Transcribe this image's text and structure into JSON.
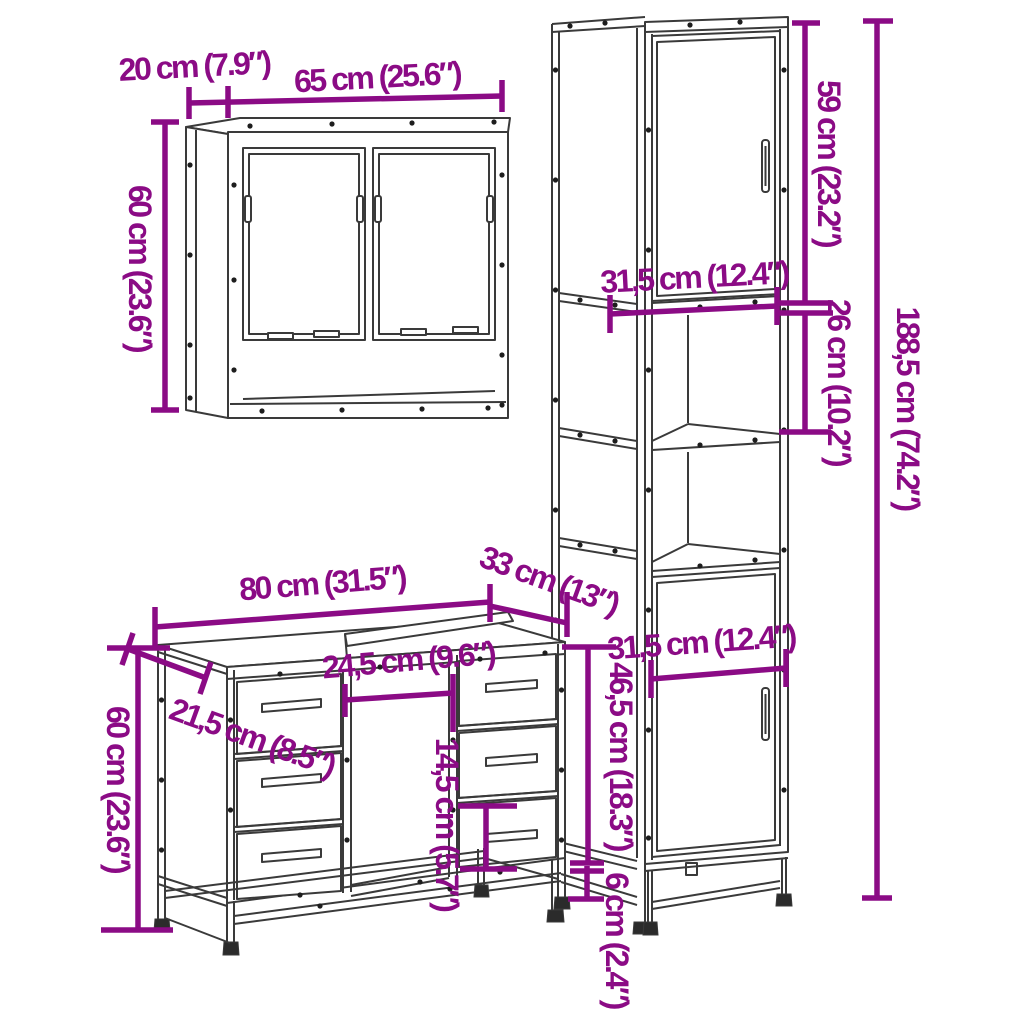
{
  "theme": {
    "accent": "#8b0b85",
    "line": "#3a3a3a",
    "dot": "#1d1d1d",
    "background": "#ffffff"
  },
  "dimensions": {
    "mirror_depth": "20 cm (7.9″)",
    "mirror_width": "65 cm (25.6″)",
    "mirror_height": "60 cm (23.6″)",
    "tall_top_door_height": "59 cm (23.2″)",
    "tall_shelf_width": "31,5 cm (12.4″)",
    "tall_compartment_height": "26 cm (10.2″)",
    "tall_total_height": "188,5 cm (74.2″)",
    "tall_bottom_door_width": "31,5 cm (12.4″)",
    "tall_bottom_door_height": "46,5 cm (18.3″)",
    "tall_leg_height": "6 cm (2.4″)",
    "vanity_width": "80 cm (31.5″)",
    "vanity_depth": "33 cm (13″)",
    "vanity_opening_width": "24,5 cm (9.6″)",
    "vanity_top_depth": "21,5 cm (8.5″)",
    "vanity_height": "60 cm (23.6″)",
    "vanity_drawer_height": "14,5 cm (5.7″)"
  }
}
